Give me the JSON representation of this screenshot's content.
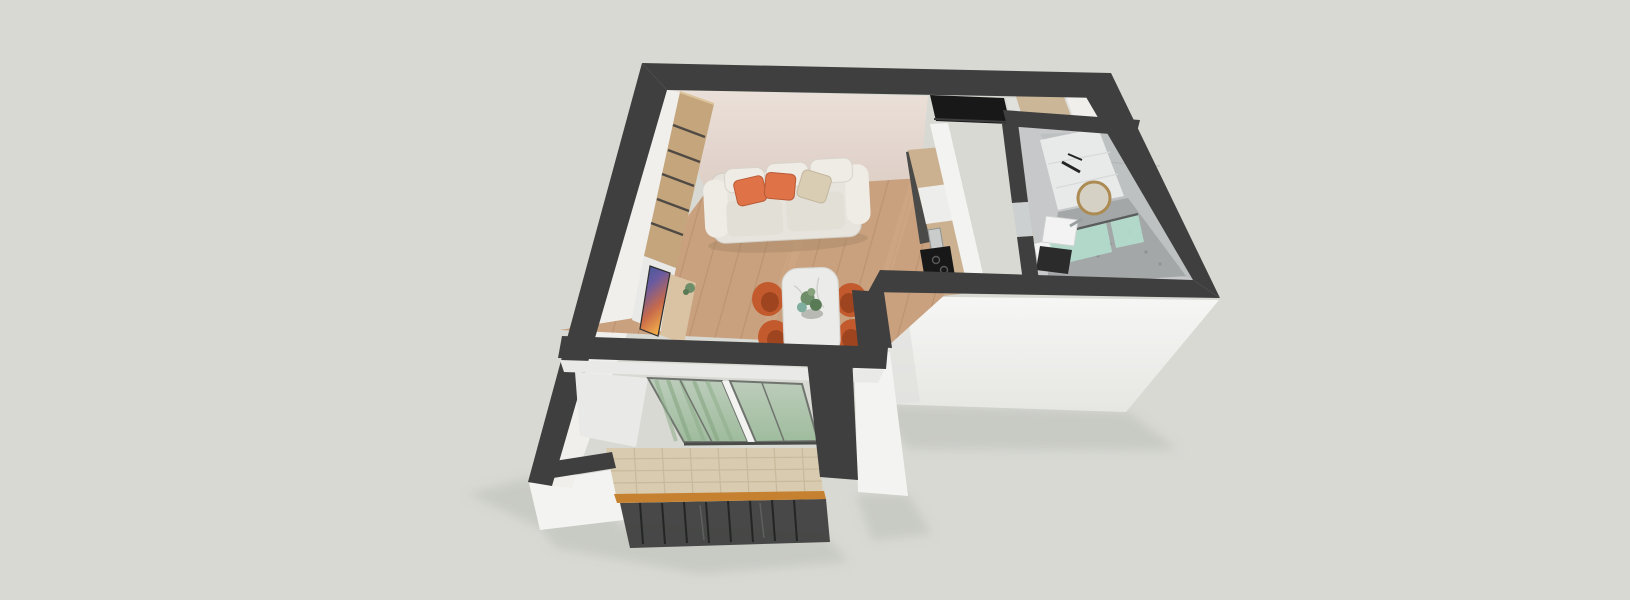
{
  "scene": {
    "type": "isometric-3d-apartment-floorplan-render",
    "rooms": [
      {
        "name": "living-dining-room",
        "objects": [
          "cream-sofa",
          "orange-pillows",
          "beige-pillow",
          "wood-wardrobe",
          "tv-artwork",
          "media-console",
          "plant",
          "dining-table-marble",
          "orange-tub-chairs",
          "plant-centerpiece",
          "wood-plank-floor",
          "pink-back-wall"
        ]
      },
      {
        "name": "kitchen-strip",
        "objects": [
          "tan-cabinets",
          "white-counter",
          "black-cooktop",
          "black-fridge-top",
          "steel-faucet"
        ]
      },
      {
        "name": "entry-hall",
        "objects": [
          "tan-wardrobe-top",
          "gray-floor"
        ]
      },
      {
        "name": "bathroom",
        "objects": [
          "round-gold-mirror",
          "white-sink",
          "dark-vanity",
          "shower-green-glass",
          "stone-shower-floor",
          "white-tile-floor",
          "gray-tiled-walls",
          "door-leaf"
        ]
      },
      {
        "name": "balcony",
        "objects": [
          "sliding-glass-doors",
          "green-curtain",
          "stone-tile-floor",
          "wood-top-railing",
          "dark-balusters"
        ]
      }
    ]
  },
  "palette": {
    "bg": "#d8d9d3",
    "groundShadow": "#bcbeb8",
    "wallDark": "#3e3f3e",
    "wallDark2": "#474847",
    "whiteFace": "#f3f3f1",
    "whiteFace2": "#e9e9e7",
    "whiteSliver": "#f0efec",
    "pinkWall": "#e9ded7",
    "pinkWallDeep": "#dfd0c7",
    "woodFloor": "#c9a17f",
    "woodSeam": "#b28a68",
    "woodStreak": "#d7b28e",
    "wardrobe": "#c4a57c",
    "wardrobeSlot": "#3b3b3b",
    "consoleWood": "#d9c3a2",
    "counterTan": "#cbb190",
    "counterWhite": "#ededeb",
    "nicheDark": "#4a4a48",
    "applianceBlack": "#181818",
    "sofaBody": "#e7e4dd",
    "sofaLight": "#efece6",
    "sofaCushion": "#e2dfd7",
    "pillowOrange": "#df7347",
    "pillowBeige": "#d9cdb4",
    "chairOrange": "#c35a2e",
    "chairInner": "#9e4520",
    "tableTop": "#ebebe9",
    "plantGreen": "#6e8e69",
    "plantDeep": "#587a55",
    "plantTeal": "#7fae9e",
    "tileBeige": "#d9cbb0",
    "tileLine": "#c0b091",
    "glassFrame": "#70746f",
    "railWood": "#c5812f",
    "balusterDark": "#3b3c3b",
    "bathWall": "#c6c8c9",
    "bathWallDeep": "#bcbfc0",
    "bathCab": "#b4b7b8",
    "bathFloorWhite": "#e8e9e9",
    "showerFloor": "#a3a7a7",
    "showerGlass": "#b5e0cf",
    "mirrorGold": "#ab8b52",
    "mirrorFace": "#d6d1c5",
    "sinkWhite": "#f2f3f2",
    "vanityDark": "#2b2b2b",
    "hallFloor": "#e0e0dd",
    "doorLeaf": "#ccd0d0",
    "tanCab": "#cbb697"
  }
}
